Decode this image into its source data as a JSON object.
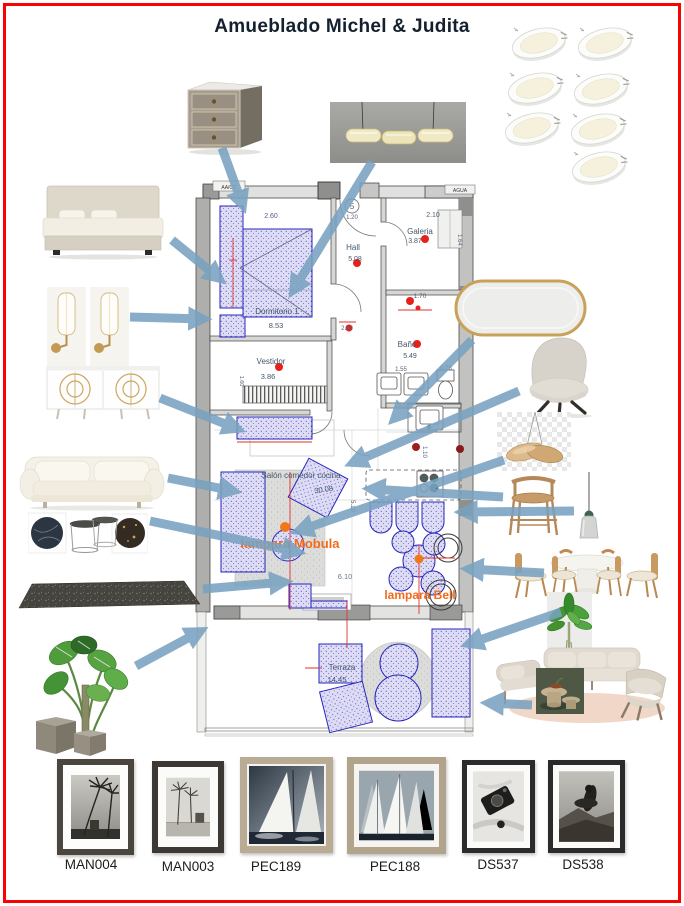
{
  "title": "Amueblado Michel & Judita",
  "plan": {
    "service_labels": {
      "hvac": "AA/CC",
      "water": "AGUA",
      "entry_number": "5"
    },
    "rooms": {
      "dormitorio": {
        "name": "Dormitorio 1",
        "area": "8.53"
      },
      "hall": {
        "name": "Hall",
        "area": "5.08"
      },
      "galeria": {
        "name": "Galeria",
        "area": "3.87"
      },
      "bano": {
        "name": "Baño",
        "area": "5.49"
      },
      "vestidor": {
        "name": "Vestidor",
        "area": "3.86"
      },
      "salon": {
        "name": "Salón comedor cocina",
        "area": "30.08"
      },
      "terraza": {
        "name": "Terraza",
        "area": "14.45"
      }
    },
    "dims": {
      "dorm_width": "2.60",
      "entry_width": "1.20",
      "galeria_width": "2.10",
      "galeria_depth": "1.64",
      "bano_top": "1.70",
      "hall_depth": "2.90",
      "bano_width": "1.55",
      "wc_width": "0.75",
      "kitchen_depth": "1.10",
      "salon_depth": "5.10",
      "salon_width": "6.10",
      "vestidor_side": "1.60"
    },
    "lamps": {
      "mobula": "lampara Mobula",
      "bell": "lampara Bell"
    }
  },
  "furniture": {
    "nightstand": "mirrored nightstand",
    "linear_pendant": "linear glass pendant light",
    "downlights": "recessed LED downlights",
    "bed": "upholstered bed",
    "sconces": "brass wall sconces",
    "sideboard": "white sideboard with gold circles",
    "sofa": "white slipcover sofa",
    "nesting_tables": "nesting tables with marble swatches",
    "rug": "dark grey rug",
    "monstera": "monstera plant with concrete pots",
    "mirror": "oval gold mirror",
    "armchair": "grey swivel armchair",
    "mobula_pendant": "wood wing pendant (Mobula)",
    "bar_stool": "oak bar stool",
    "bell_pendant": "bell pendant lamp",
    "dining_set": "round white table with oak chairs",
    "leaf_plant": "potted leaf plant",
    "outdoor_set": "outdoor lounge set with coffee tables"
  },
  "artworks": [
    {
      "code": "MAN004"
    },
    {
      "code": "MAN003"
    },
    {
      "code": "PEC189"
    },
    {
      "code": "PEC188"
    },
    {
      "code": "DS537"
    },
    {
      "code": "DS538"
    }
  ]
}
